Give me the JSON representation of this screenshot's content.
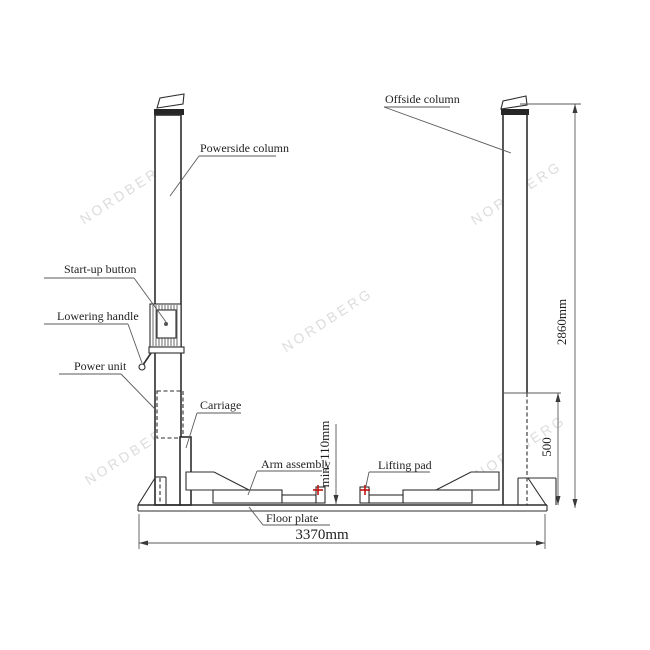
{
  "watermark": {
    "text": "NORDBERG"
  },
  "labels": {
    "powerside_column": "Powerside column",
    "offside_column": "Offside column",
    "startup_button": "Start-up button",
    "lowering_handle": "Lowering handle",
    "power_unit": "Power unit",
    "carriage": "Carriage",
    "arm_assembly": "Arm assembly",
    "lifting_pad": "Lifting pad",
    "floor_plate": "Floor plate"
  },
  "dimensions": {
    "overall_height": "2860mm",
    "overall_width": "3370mm",
    "base_section_height": "500",
    "min_pad_height": "min=110mm"
  },
  "colors": {
    "line": "#2d2d2d",
    "thin_line": "#5a5a5a",
    "lifting_point_red": "#c21212",
    "watermark_gray": "#dcdcdc",
    "background": "#ffffff"
  }
}
